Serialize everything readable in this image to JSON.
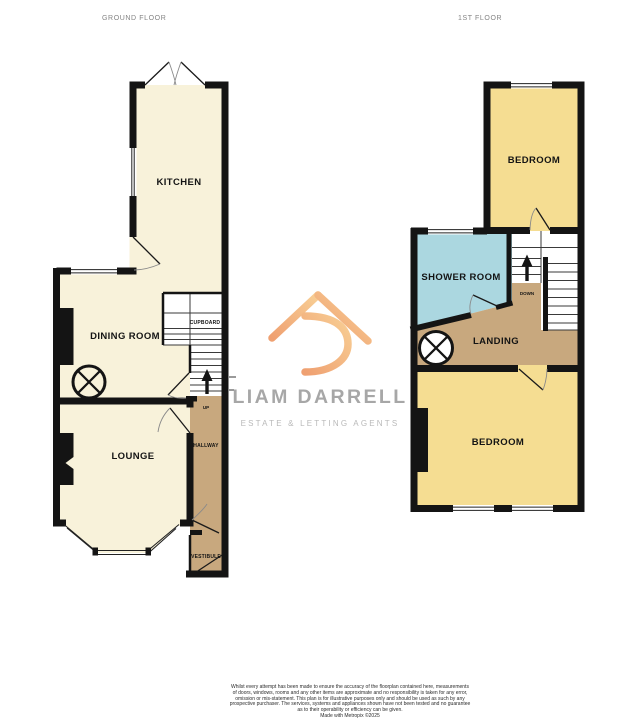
{
  "ground_floor": {
    "title": "GROUND FLOOR",
    "labels": {
      "kitchen": "KITCHEN",
      "dining_room": "DINING ROOM",
      "cupboard": "CUPBOARD",
      "up": "UP",
      "hallway": "HALLWAY",
      "lounge": "LOUNGE",
      "vestibule": "VESTIBULE"
    }
  },
  "first_floor": {
    "title": "1ST FLOOR",
    "labels": {
      "bedroom_front": "BEDROOM",
      "shower_room": "SHOWER ROOM",
      "down": "DOWN",
      "landing": "LANDING",
      "bedroom_rear": "BEDROOM"
    }
  },
  "watermark": {
    "brand": "LIAM DARRELL",
    "tagline": "ESTATE & LETTING AGENTS"
  },
  "disclaimer": {
    "lines": [
      "Whilst every attempt has been made to ensure the accuracy of the floorplan contained here, measurements",
      "of doors, windows, rooms and any other items are approximate and no responsibility is taken for any error,",
      "omission or mis-statement. This plan is for illustrative purposes only and should be used as such by any",
      "prospective purchaser. The services, systems and appliances shown have not been tested and no guarantee",
      "as to their operability or efficiency can be given.",
      "Made with Metropix ©2025"
    ]
  },
  "colors": {
    "room-cream": "#f8f2da",
    "room-yellow": "#f5dd92",
    "room-blue": "#abd7e0",
    "room-tan": "#c8a87e",
    "wall": "#141414",
    "logo-orange-start": "#efa071",
    "logo-orange-end": "#f8cf95",
    "brand-text": "#a7a7a7",
    "tagline-text": "#b9b9b9",
    "floor-title": "#848484"
  }
}
